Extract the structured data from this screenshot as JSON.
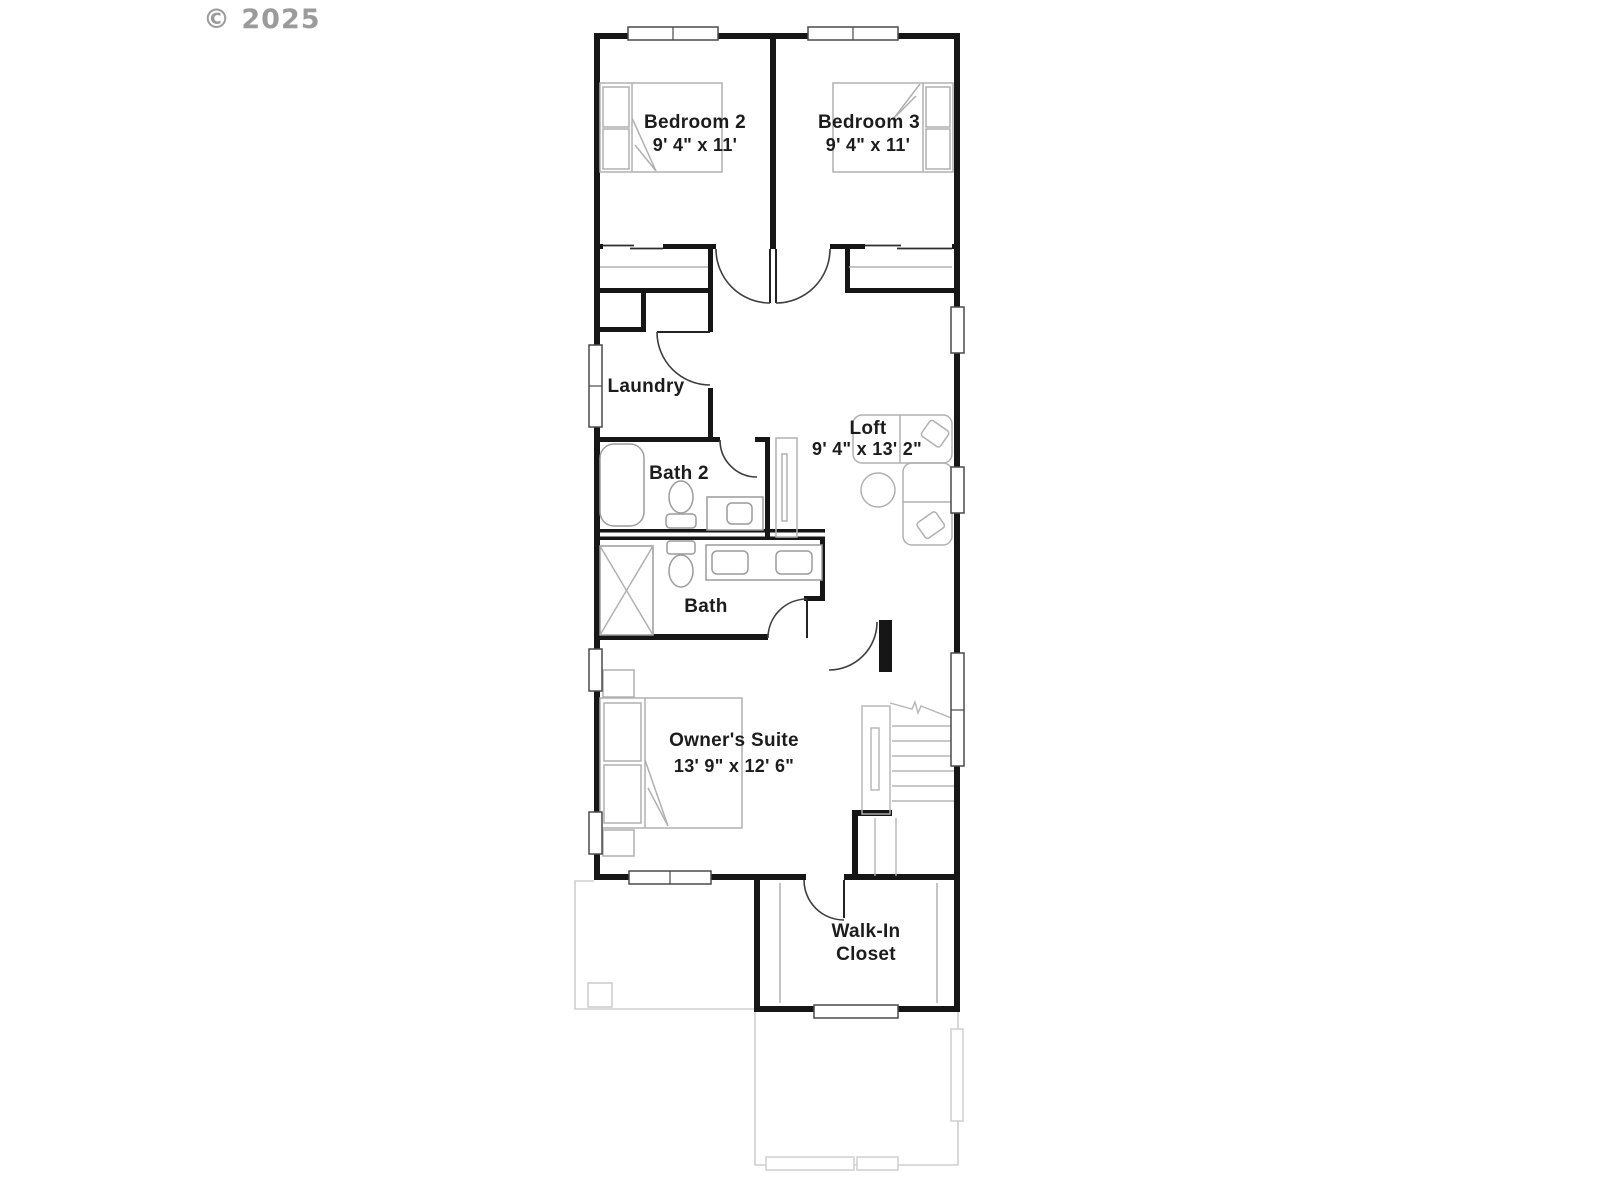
{
  "copyright": "© 2025",
  "plan": {
    "bedroom2": {
      "name": "Bedroom 2",
      "dims": "9' 4\" x 11'"
    },
    "bedroom3": {
      "name": "Bedroom 3",
      "dims": "9' 4\" x 11'"
    },
    "laundry": {
      "name": "Laundry"
    },
    "bath2": {
      "name": "Bath 2"
    },
    "loft": {
      "name": "Loft",
      "dims": "9' 4\" x 13' 2\""
    },
    "bath": {
      "name": "Bath"
    },
    "owners_suite": {
      "name": "Owner's Suite",
      "dims": "13' 9\" x 12' 6\""
    },
    "walkin_closet": {
      "line1": "Walk-In",
      "line2": "Closet"
    }
  },
  "colors": {
    "walls": "#161616",
    "furniture_outline": "#b0b0b0",
    "lower_level_outline": "#cfcfcf",
    "label_text": "#1c1c1c",
    "copyright_text": "#9b9b9b"
  }
}
